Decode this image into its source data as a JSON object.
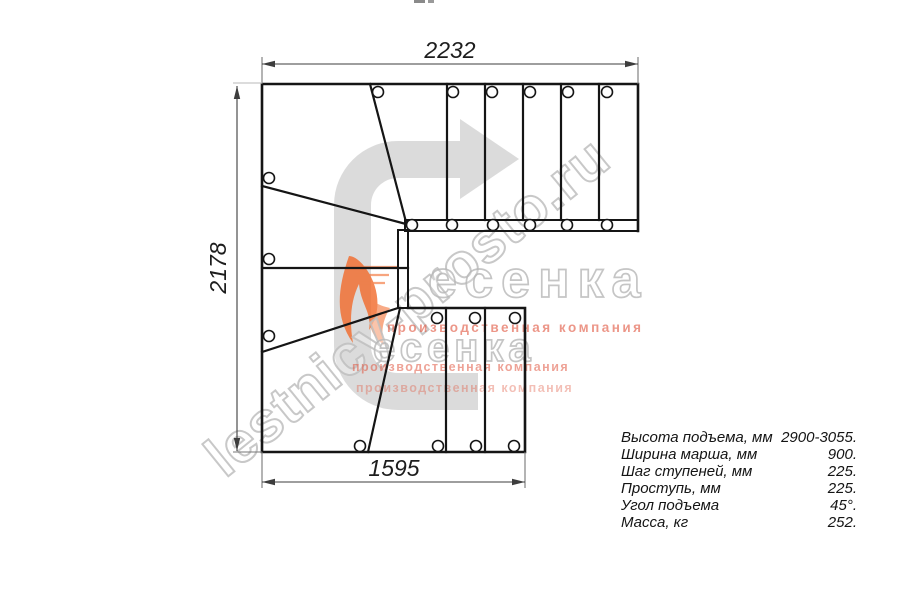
{
  "page": {
    "background": "#ffffff"
  },
  "dimensions": {
    "top": "2232",
    "left": "2178",
    "bottom": "1595"
  },
  "specs": {
    "rows": [
      {
        "label": "Высота подъема, мм",
        "value": "2900-3055."
      },
      {
        "label": "Ширина марша, мм",
        "value": "900."
      },
      {
        "label": "Шаг ступеней, мм",
        "value": "225."
      },
      {
        "label": "Проступь, мм",
        "value": "225."
      },
      {
        "label": "Угол подъема",
        "value": "45°."
      },
      {
        "label": "Масса, кг",
        "value": "252."
      }
    ]
  },
  "watermark": {
    "site": "lestnicy-prosto.ru",
    "brand": "есенка",
    "tagline": "производственная компания",
    "colors": {
      "outline": "#c6c6c6",
      "tagline_red": "#e0563f",
      "flame_orange": "#f26a2a",
      "arrow_gray": "#d8d8d8"
    }
  }
}
